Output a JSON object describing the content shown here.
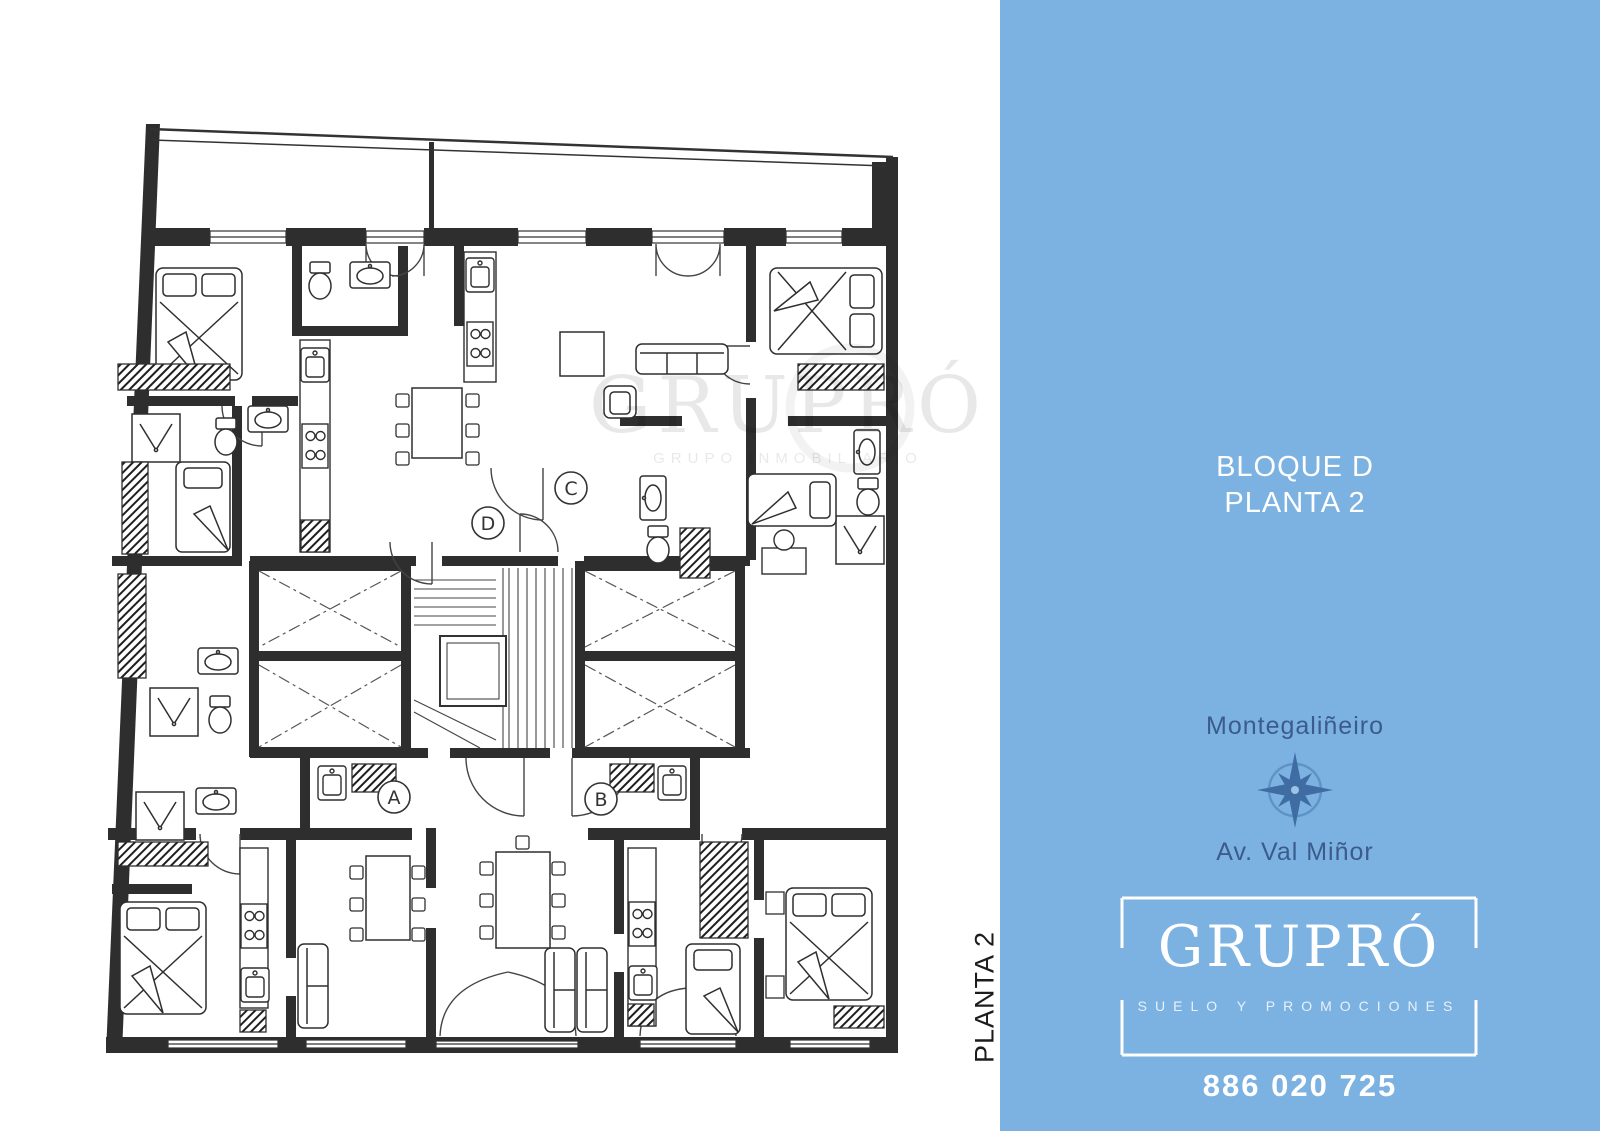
{
  "panel": {
    "background": "#7cb2e1",
    "title_line1": "BLOQUE D",
    "title_line2": "PLANTA 2",
    "location": "Montegaliñeiro",
    "street": "Av. Val Miñor",
    "text_color": "#3b5b8c",
    "compass_color": "#3f6da3",
    "logo": {
      "name": "GRUPRÓ",
      "tagline": "SUELO Y PROMOCIONES",
      "phone": "886 020 725"
    }
  },
  "plan": {
    "side_label": "PLANTA 2",
    "wall_color": "#2e2e2e",
    "watermark": {
      "text": "GRUPRÓ",
      "subtext": "GRUPO INMOBILIARIO"
    },
    "units": [
      {
        "label": "A"
      },
      {
        "label": "B"
      },
      {
        "label": "C"
      },
      {
        "label": "D"
      }
    ]
  }
}
